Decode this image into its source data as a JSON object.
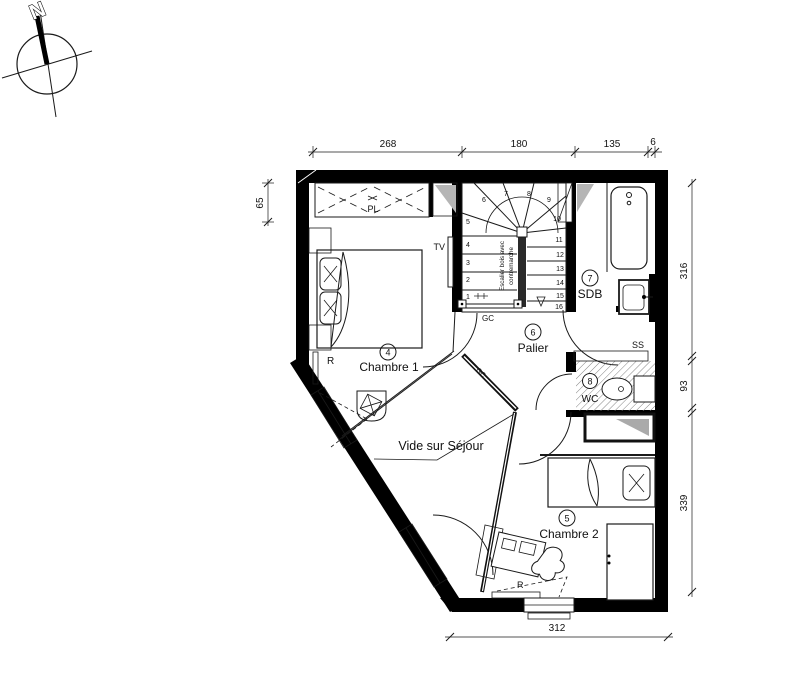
{
  "north": {
    "label": "N"
  },
  "dimensions": {
    "top": [
      "268",
      "180",
      "135",
      "6"
    ],
    "left": [
      "65"
    ],
    "right": [
      "316",
      "93",
      "339"
    ],
    "bottom": [
      "312"
    ]
  },
  "rooms": {
    "chambre1": {
      "number": "4",
      "name": "Chambre 1"
    },
    "chambre2": {
      "number": "5",
      "name": "Chambre 2"
    },
    "palier": {
      "number": "6",
      "name": "Palier"
    },
    "sdb": {
      "number": "7",
      "name": "SDB"
    },
    "wc": {
      "number": "8",
      "name": "WC"
    }
  },
  "labels": {
    "closet": "PL",
    "tv": "TV",
    "void": "Vide sur Séjour",
    "guardrail": "GC",
    "guardrail2": "GC",
    "towel_rail": "SS",
    "radiator1": "R",
    "radiator2": "R",
    "stair_note_line1": "Escalier bois avec",
    "stair_note_line2": "contremarche"
  },
  "stairs": {
    "steps": [
      "1",
      "2",
      "3",
      "4",
      "5",
      "6",
      "7",
      "8",
      "9",
      "10",
      "11",
      "12",
      "13",
      "14",
      "15",
      "16"
    ]
  },
  "colors": {
    "ink": "#1a1a1a",
    "wall": "#000000",
    "shade": "#b5b5b5"
  }
}
